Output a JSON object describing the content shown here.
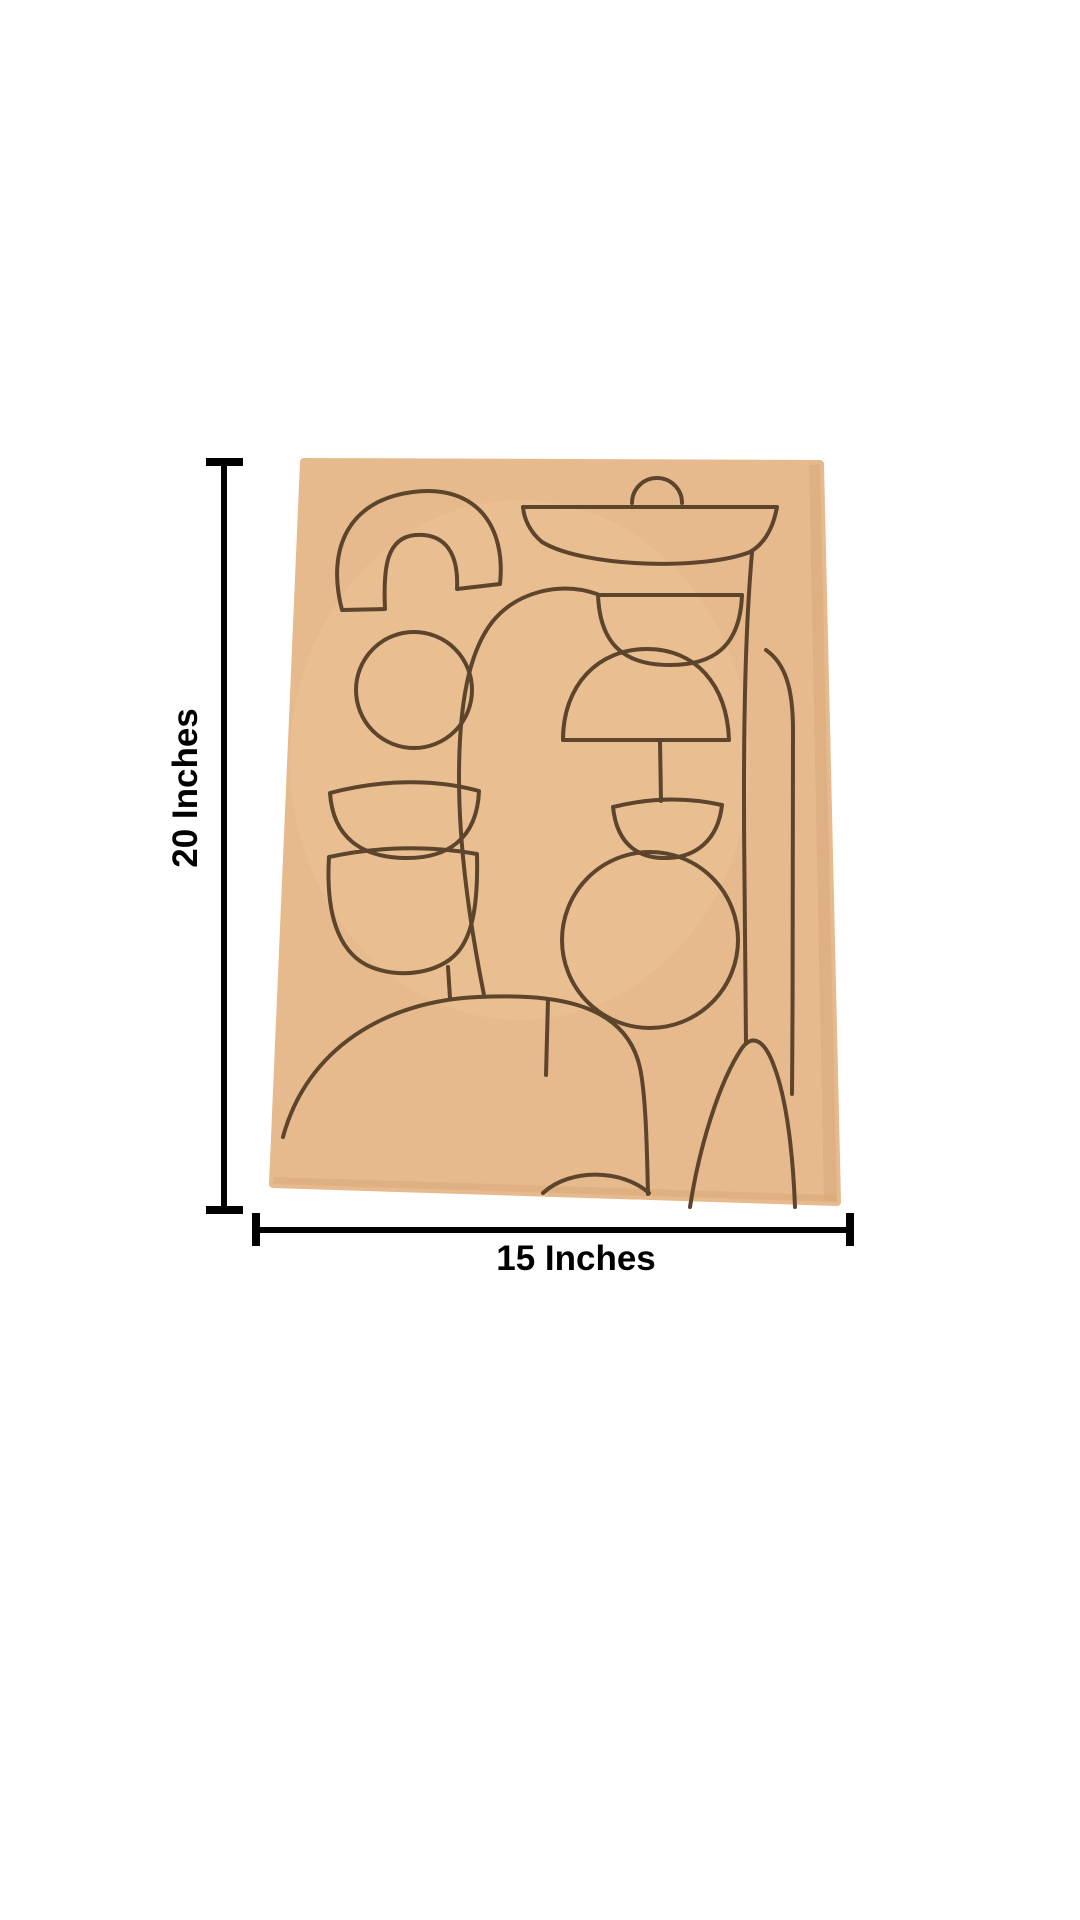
{
  "figure": {
    "type": "product-dimension-image",
    "height_label": "20 Inches",
    "width_label": "15 Inches",
    "height_value": 20,
    "width_value": 15,
    "unit": "Inches"
  },
  "board": {
    "description_shapes": [
      "rainbow-arch",
      "small-circle",
      "shallow-bowl",
      "deep-cup",
      "cup-stem",
      "bottom-left-dome",
      "dome-divider",
      "center-arch",
      "fountain-top-semicircle",
      "fountain-dish",
      "fountain-half-bowl",
      "fountain-dome",
      "fountain-stem",
      "fountain-small-bowl",
      "fountain-circle",
      "right-door-arch",
      "bottom-right-hill",
      "bottom-mound"
    ]
  },
  "colors": {
    "background": "#ffffff",
    "board_fill": "#e7ba8d",
    "board_fill_light": "#eec79c",
    "board_edge_shade": "#d9a878",
    "line_art": "#5c452c",
    "dimension": "#000000"
  }
}
